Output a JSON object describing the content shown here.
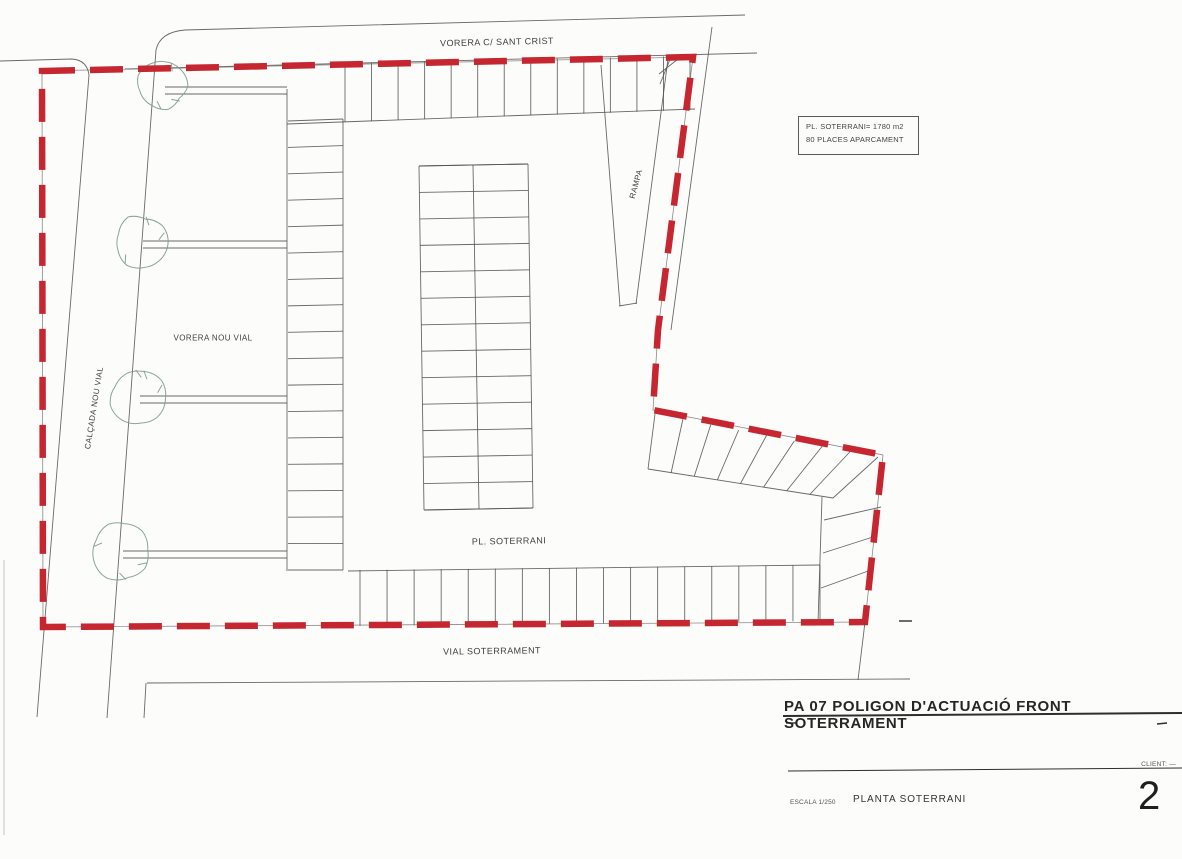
{
  "colors": {
    "boundary_red": "#c62630",
    "line": "#4f4f4f",
    "tree": "#7e9c8d",
    "text": "#3f3f3f",
    "title": "#262626"
  },
  "plan": {
    "labels": {
      "top_street": "VORERA C/ SANT CRIST",
      "ramp": "RAMPA",
      "left_sidewalk": "VORERA NOU VIAL",
      "left_road": "CALÇADA NOU VIAL",
      "basement": "PL. SOTERRANI",
      "bottom_road": "VIAL SOTERRAMENT"
    },
    "info_box": {
      "line1": "PL. SOTERRANI= 1780 m2",
      "line2": "80 PLACES APARCAMENT"
    }
  },
  "title_block": {
    "title": "PA 07 POLIGON D'ACTUACIÓ FRONT SOTERRAMENT",
    "client_label": "CLIENT: —",
    "scale_label": "ESCALA 1/250",
    "drawing_name": "PLANTA SOTERRANI",
    "sheet_number": "2"
  }
}
